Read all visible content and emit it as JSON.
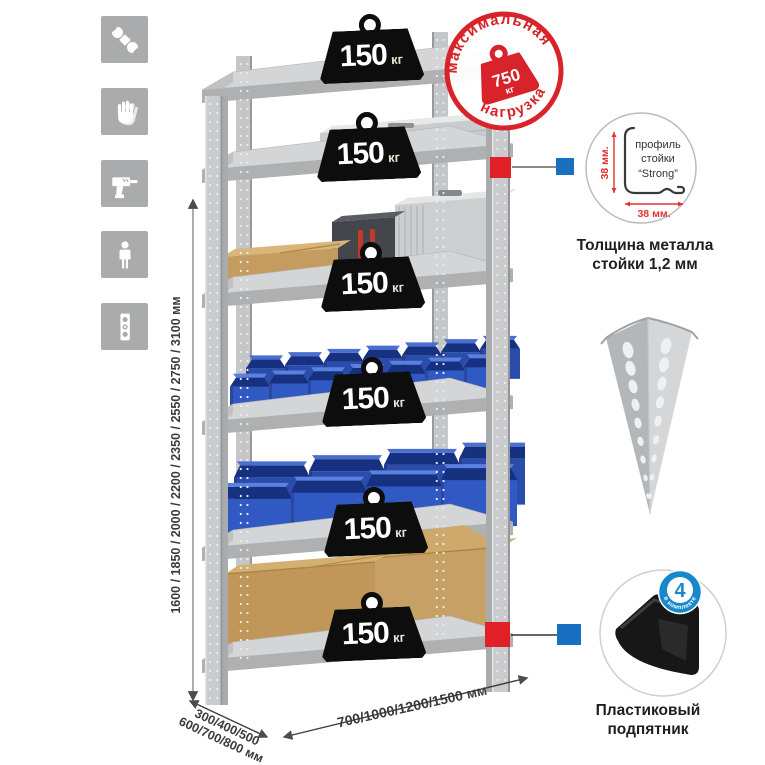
{
  "canvas": {
    "width": 765,
    "height": 765,
    "background": "#ffffff"
  },
  "colors": {
    "accent_red": "#d8232a",
    "marker_red": "#e01f26",
    "marker_blue": "#1a6fc0",
    "badge_blue": "#1789cb",
    "icon_bg": "#a9abad",
    "bin_blue": "#3059c4",
    "cardboard": "#c49c60",
    "metal_gray": "#c9cbcd",
    "weight_black": "#0d0d0d"
  },
  "sidebar": {
    "icons": [
      {
        "name": "wrench"
      },
      {
        "name": "gloves"
      },
      {
        "name": "drill"
      },
      {
        "name": "person"
      },
      {
        "name": "level"
      }
    ]
  },
  "rack": {
    "shelf_count": 6,
    "shelves": [
      {
        "capacity": "150",
        "unit": "кг"
      },
      {
        "capacity": "150",
        "unit": "кг"
      },
      {
        "capacity": "150",
        "unit": "кг"
      },
      {
        "capacity": "150",
        "unit": "кг"
      },
      {
        "capacity": "150",
        "unit": "кг"
      },
      {
        "capacity": "150",
        "unit": "кг"
      }
    ]
  },
  "max_load_stamp": {
    "arc_top": "максимальная",
    "arc_bottom": "нагрузка",
    "value": "750",
    "unit": "кг"
  },
  "profile_detail": {
    "labels": [
      "профиль",
      "стойки",
      "“Strong”"
    ],
    "dim_vertical": "38 мм.",
    "dim_horizontal": "38 мм.",
    "caption": [
      "Толщина металла",
      "стойки 1,2 мм"
    ]
  },
  "foot_detail": {
    "badge_value": "4",
    "badge_arc": "в комплекте",
    "caption": [
      "Пластиковый",
      "подпятник"
    ]
  },
  "dimensions": {
    "height": "1600 / 1850 / 2000 / 2200 / 2350 / 2550 / 2750 / 3100 мм",
    "depth": [
      "300/400/500",
      "600/700/800 мм"
    ],
    "width": "700/1000/1200/1500 мм"
  }
}
